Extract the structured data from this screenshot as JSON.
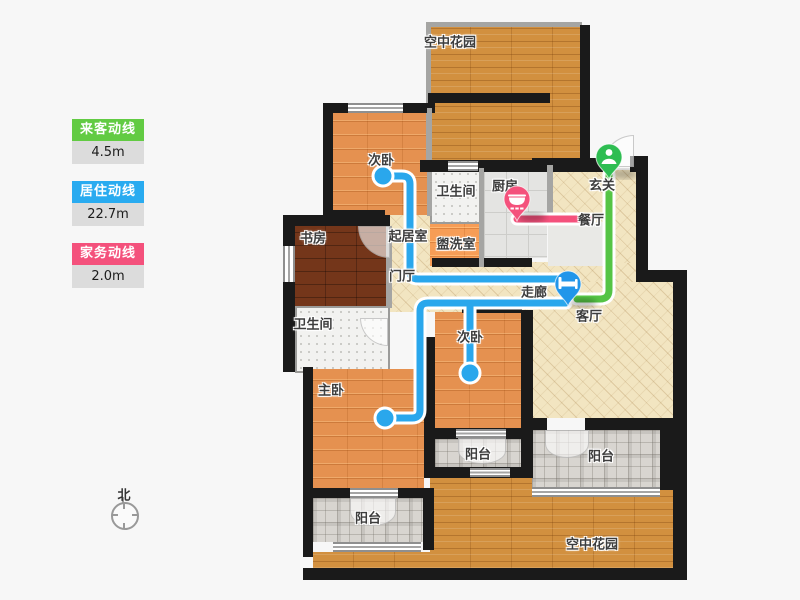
{
  "legend": {
    "items": [
      {
        "name": "来客动线",
        "value": "4.5m",
        "color": "#62cb43"
      },
      {
        "name": "居住动线",
        "value": "22.7m",
        "color": "#29abf0"
      },
      {
        "name": "家务动线",
        "value": "2.0m",
        "color": "#f4517c"
      }
    ]
  },
  "lines": {
    "visitor": {
      "label": "来客动线",
      "length": "4.5m",
      "color": "#55c445"
    },
    "living": {
      "label": "居住动线",
      "length": "22.7m",
      "color": "#2aa7ec"
    },
    "housework": {
      "label": "家务动线",
      "length": "2.0m",
      "color": "#f4517c"
    }
  },
  "pins": {
    "entry": {
      "icon": "person-icon",
      "color": "#2ebd52"
    },
    "bed": {
      "icon": "bed-icon",
      "color": "#2196ea"
    },
    "pot": {
      "icon": "pot-icon",
      "color": "#f4517c"
    }
  },
  "rooms": {
    "garden_top": "空中花园",
    "bedroom2_top": "次卧",
    "bath_top": "卫生间",
    "kitchen": "厨房",
    "foyer": "玄关",
    "dining": "餐厅",
    "study": "书房",
    "sitting": "起居室",
    "washroom": "盥洗室",
    "hall_entry": "门厅",
    "corridor": "走廊",
    "living": "客厅",
    "bath_left": "卫生间",
    "master": "主卧",
    "bedroom2_bottom": "次卧",
    "balcony_center": "阳台",
    "balcony_left": "阳台",
    "balcony_right": "阳台",
    "garden_bottom": "空中花园"
  },
  "compass": {
    "label": "北"
  }
}
